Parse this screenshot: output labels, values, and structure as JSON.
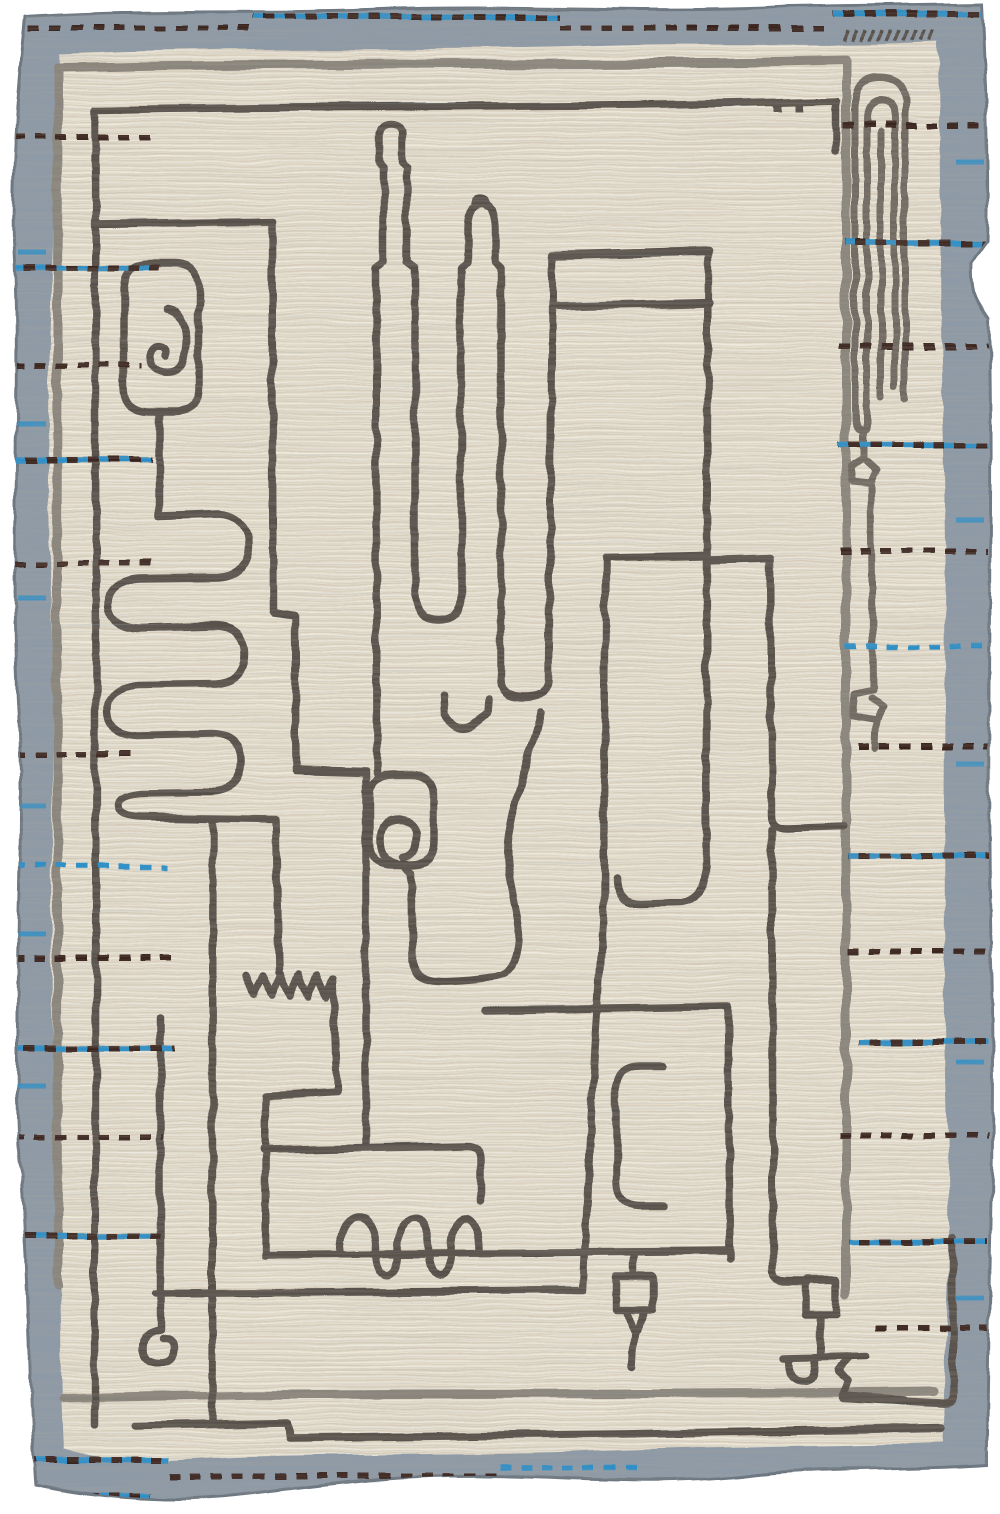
{
  "image": {
    "type": "photograph",
    "subject": "Handwoven modern Moroccan-style wool area rug, portrait orientation, shown flat on white background",
    "style": "Abstract minimalist charcoal line-art maze of tubes, capsules, spirals, serpentine meanders, combs and goblet doodles on an ivory striated field, framed by a slate blue-gray flatweave border with running-stitch dashes",
    "background": "#ffffff"
  },
  "palette": {
    "page_bg": "#ffffff",
    "border": "#8d9aa7",
    "border_edge": "#6e7882",
    "field": "#e9e2d1",
    "field_stripe_dark": "#c9bfa9",
    "field_stripe_light": "#f6f1e4",
    "gray_line": "#8a857c",
    "mid_line": "#6e6860",
    "charcoal": "#565049",
    "stitch_brown": "#38241d",
    "stitch_blue": "#2b8fc9"
  },
  "border": {
    "description": "slate blue-gray band ~40px wide on all four sides with irregular handwoven edges",
    "stitch_style": "running-stitch dashes in espresso brown and azure blue, stepping rows along top and bottom, short rows piercing inward from left and right"
  },
  "motifs": [
    {
      "name": "outer-gray-frame",
      "description": "light gray open rectangle frame line inside the field"
    },
    {
      "name": "inner-charcoal-frame",
      "description": "charcoal open frame line nested inside the gray frame"
    },
    {
      "name": "capsule-spiral",
      "description": "rounded capsule with small spiral inside, upper left"
    },
    {
      "name": "serpentine-meander",
      "description": "snake-like meander of four rounded fingers, left middle"
    },
    {
      "name": "sawtooth-teeth",
      "description": "small zigzag tooth row below the meander"
    },
    {
      "name": "bottle-snake",
      "description": "two bottle/thermometer shaped tall tubes with U-turn returns, upper center"
    },
    {
      "name": "v-notch",
      "description": "small floating w notch, center"
    },
    {
      "name": "loop-capsule",
      "description": "small rounded box with curl loop inside, center"
    },
    {
      "name": "big-block",
      "description": "large tall rectangle with double bar top and rounded foot, center right"
    },
    {
      "name": "paperclip",
      "description": "nested elongated arches like a paperclip, top right, with tick marks above"
    },
    {
      "name": "side-hooks",
      "description": "two small knotted hooks on a vertical line, right side"
    },
    {
      "name": "comb-room",
      "description": "bottom chamber with loop-de-loop comb arches riding a long baseline"
    },
    {
      "name": "bracket",
      "description": "rounded C bracket open to the right, lower center-right"
    },
    {
      "name": "pennant-pole",
      "description": "small flag square with funnel tail on a pole, bottom center-right"
    },
    {
      "name": "robot-goblet",
      "description": "square head on a stem with cross bar, cup and stair-step foot, bottom right"
    },
    {
      "name": "corner-spiral",
      "description": "small curl spiral, bottom left"
    }
  ],
  "stitch_rows": {
    "left": [
      {
        "y": 137,
        "x1": 14,
        "x2": 158,
        "style": "brown"
      },
      {
        "y": 268,
        "x1": 14,
        "x2": 160,
        "style": "mixed"
      },
      {
        "y": 365,
        "x1": 14,
        "x2": 142,
        "style": "brown"
      },
      {
        "y": 460,
        "x1": 14,
        "x2": 152,
        "style": "mixed"
      },
      {
        "y": 563,
        "x1": 14,
        "x2": 152,
        "style": "brown"
      },
      {
        "y": 754,
        "x1": 14,
        "x2": 137,
        "style": "brown"
      },
      {
        "y": 866,
        "x1": 14,
        "x2": 167,
        "style": "blue"
      },
      {
        "y": 959,
        "x1": 14,
        "x2": 175,
        "style": "brown"
      },
      {
        "y": 1049,
        "x1": 14,
        "x2": 174,
        "style": "mixed"
      },
      {
        "y": 1137,
        "x1": 14,
        "x2": 163,
        "style": "brown"
      },
      {
        "y": 1236,
        "x1": 14,
        "x2": 160,
        "style": "mixed"
      }
    ],
    "right": [
      {
        "y": 125,
        "x1": 843,
        "x2": 988,
        "style": "brown"
      },
      {
        "y": 243,
        "x1": 845,
        "x2": 988,
        "style": "mixed"
      },
      {
        "y": 346,
        "x1": 839,
        "x2": 988,
        "style": "brown"
      },
      {
        "y": 445,
        "x1": 839,
        "x2": 988,
        "style": "mixed"
      },
      {
        "y": 551,
        "x1": 839,
        "x2": 988,
        "style": "brown"
      },
      {
        "y": 646,
        "x1": 846,
        "x2": 988,
        "style": "blue"
      },
      {
        "y": 746,
        "x1": 858,
        "x2": 988,
        "style": "brown"
      },
      {
        "y": 856,
        "x1": 848,
        "x2": 988,
        "style": "mixed"
      },
      {
        "y": 951,
        "x1": 849,
        "x2": 988,
        "style": "brown"
      },
      {
        "y": 1041,
        "x1": 859,
        "x2": 988,
        "style": "mixed"
      },
      {
        "y": 1136,
        "x1": 839,
        "x2": 988,
        "style": "brown"
      },
      {
        "y": 1242,
        "x1": 849,
        "x2": 988,
        "style": "mixed"
      },
      {
        "y": 1328,
        "x1": 875,
        "x2": 988,
        "style": "brown"
      }
    ],
    "top": [
      {
        "y": 28,
        "x1": 8,
        "x2": 253,
        "style": "brown"
      },
      {
        "y": 16,
        "x1": 253,
        "x2": 560,
        "style": "mixed"
      },
      {
        "y": 28,
        "x1": 560,
        "x2": 832,
        "style": "brown"
      },
      {
        "y": 14,
        "x1": 832,
        "x2": 982,
        "style": "mixed"
      }
    ],
    "bottom": [
      {
        "y": 1460,
        "x1": 15,
        "x2": 170,
        "style": "mixed"
      },
      {
        "y": 1476,
        "x1": 170,
        "x2": 500,
        "style": "brown"
      },
      {
        "y": 1468,
        "x1": 500,
        "x2": 645,
        "style": "blue"
      },
      {
        "y": 1486,
        "x1": 575,
        "x2": 792,
        "style": "brown"
      },
      {
        "y": 1477,
        "x1": 797,
        "x2": 984,
        "style": "brown"
      },
      {
        "y": 1502,
        "x1": 782,
        "x2": 984,
        "style": "mixed"
      },
      {
        "y": 1496,
        "x1": 15,
        "x2": 152,
        "style": "mixed"
      }
    ]
  },
  "border_accents": {
    "left": {
      "x1": 18,
      "x2": 46,
      "ys": [
        252,
        424,
        598,
        806,
        934,
        1086
      ]
    },
    "right": {
      "x1": 956,
      "x2": 984,
      "ys": [
        162,
        520,
        764,
        1062,
        1298
      ]
    }
  },
  "tick_marks": {
    "row_above_paperclip": {
      "x_start": 845,
      "y": 30,
      "count": 11,
      "spacing": 8.5,
      "len": 11
    }
  },
  "frame_dots": {
    "y": 103,
    "xs": [
      774,
      796
    ],
    "w": 8,
    "h": 9
  }
}
